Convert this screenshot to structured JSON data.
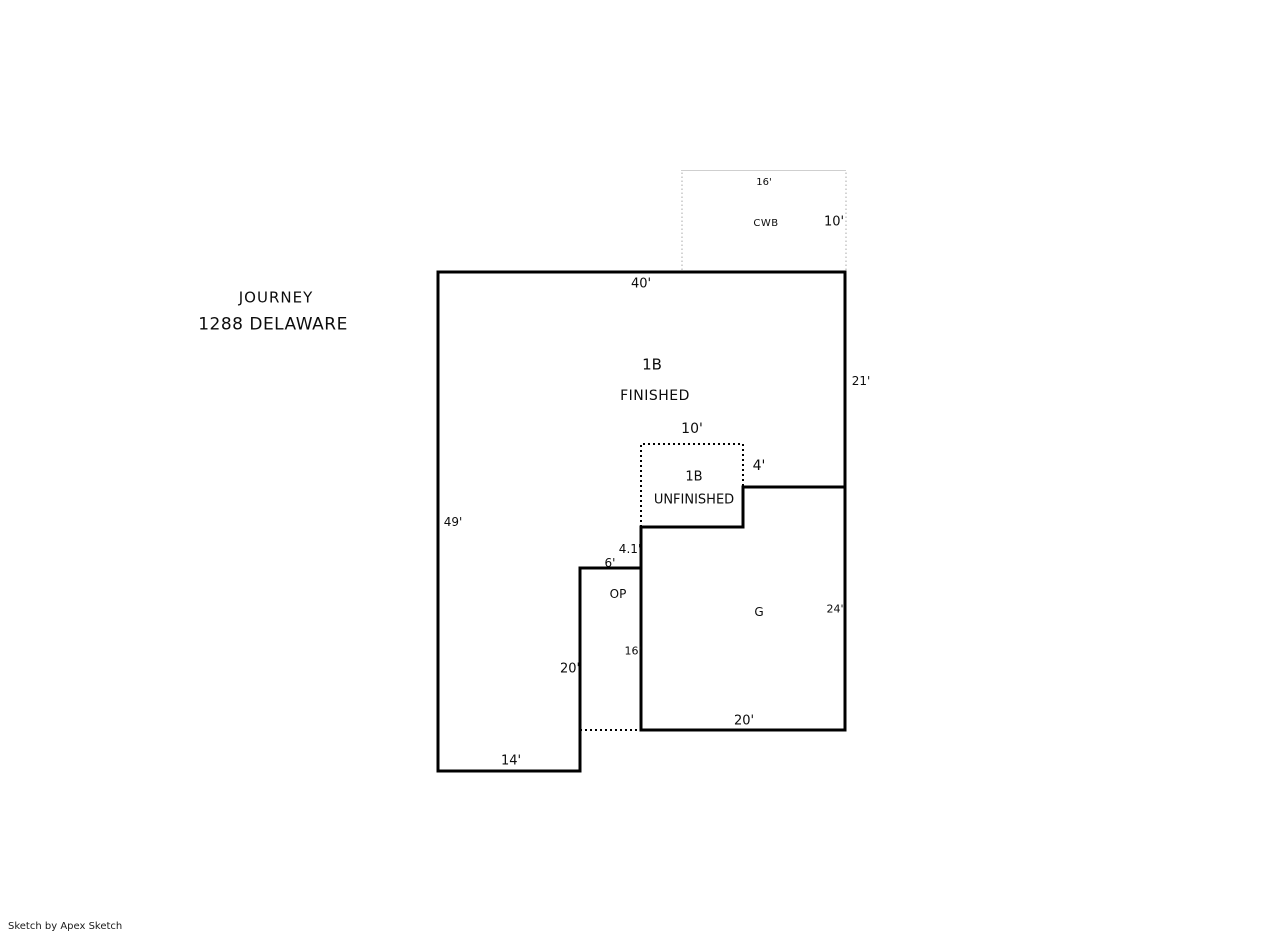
{
  "header": {
    "project_name": "JOURNEY",
    "address": "1288 DELAWARE"
  },
  "footer": {
    "watermark": "Sketch by Apex Sketch"
  },
  "colors": {
    "outline": "#000000",
    "text": "#0c0c0c",
    "cwb_outline": "#c6c6c6",
    "background": "#ffffff"
  },
  "areas": {
    "finished": {
      "code": "1B",
      "status": "FINISHED",
      "dim_top": "40'",
      "dim_right": "21'",
      "dim_left": "49'",
      "dim_bottom": "14'"
    },
    "unfinished": {
      "code": "1B",
      "status": "UNFINISHED",
      "dim_top": "10'",
      "dim_right": "4'"
    },
    "porch": {
      "code": "OP",
      "dim_step": "4.1'",
      "dim_top": "6'",
      "dim_right": "16'",
      "dim_left": "20'"
    },
    "garage": {
      "code": "G",
      "dim_right": "24'",
      "dim_bottom": "20'"
    },
    "cwb": {
      "code": "CWB",
      "dim_top": "16'",
      "dim_right": "10'"
    }
  }
}
